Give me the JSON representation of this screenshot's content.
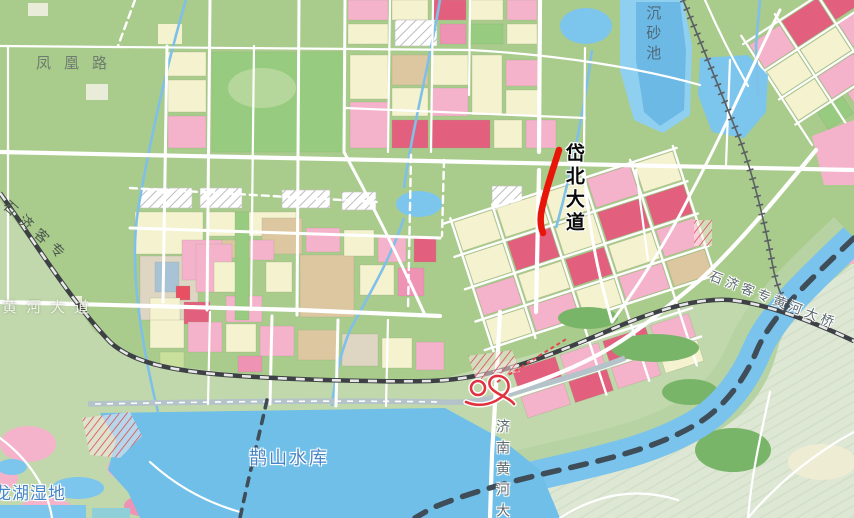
{
  "map": {
    "labels": {
      "fenghuang_road": "凤凰路",
      "sedimentation_basin": "沉砂池",
      "daibei_avenue": "岱北大道",
      "shiji_passenger_rail": "石济客专",
      "huanghe_avenue": "黄河大道",
      "queshan_reservoir": "鹊山水库",
      "longhu_wetland": "龙湖湿地",
      "jinan_yellow_river_bridge": "济南黄河大",
      "shiji_rail_yellow_river_bridge": "石济客专黄河大桥"
    },
    "highlight": {
      "highlighted_road": "岱北大道",
      "segment_color": "#e81508"
    },
    "colors": {
      "land": "#a9cb8c",
      "land_south": "#c0d8ac",
      "land_far_south": "#dde7d4",
      "water": "#7cc5ed",
      "water_deep": "#6db9e6",
      "zone_residential_pink": "#f4b3ca",
      "zone_commercial_rose": "#e2607e",
      "zone_public_cream": "#f5f2cf",
      "zone_industrial_tan": "#ddc7a0",
      "zone_park_green": "#97cb7f",
      "road": "#ffffff",
      "railway": "#3d4044",
      "boundary_dash": "#3f4d59"
    }
  }
}
